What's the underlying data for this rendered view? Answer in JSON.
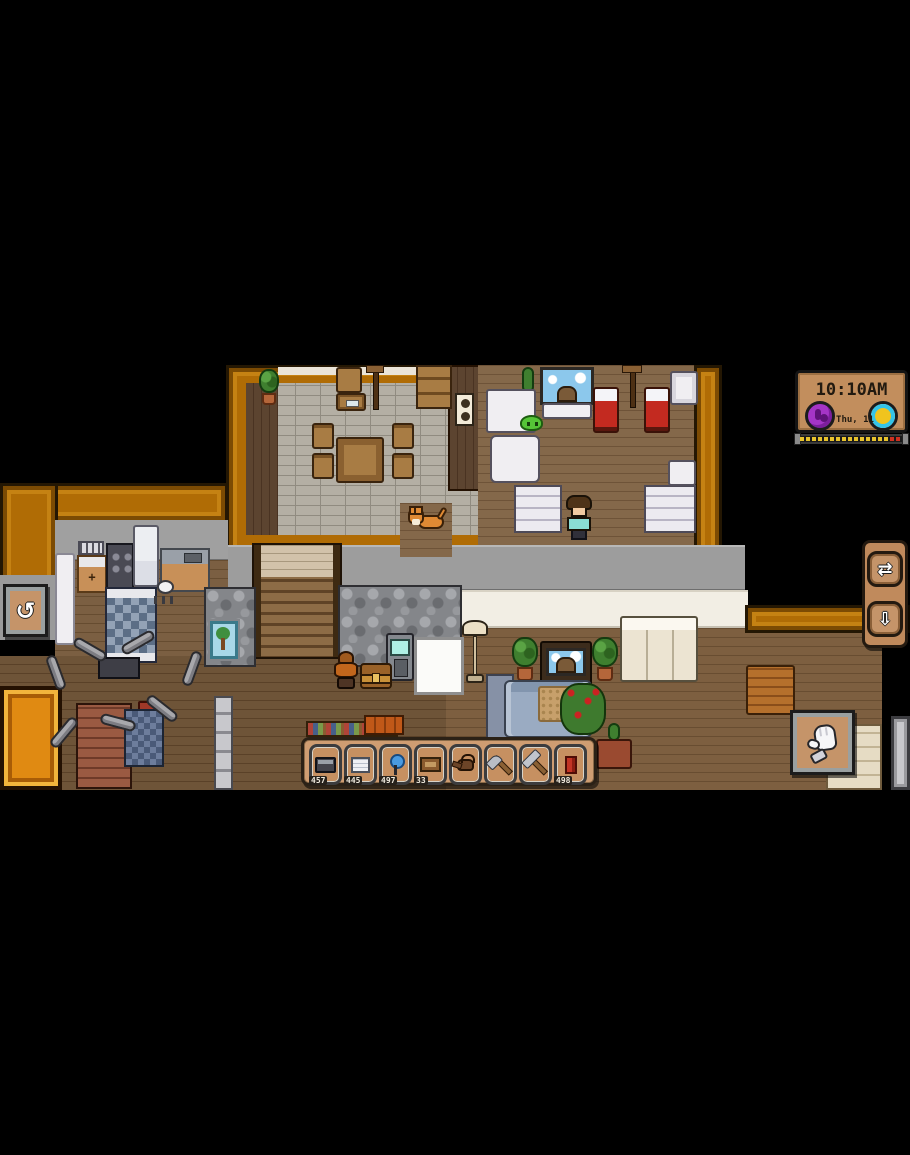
{
  "app": {
    "type": "pixel-life-sim-game",
    "view": "house-interior"
  },
  "clock": {
    "time": "10:10AM",
    "date": "Thu, 11"
  },
  "icons": {
    "rotate": "↺",
    "swap": "⇄",
    "pickup": "⇩"
  },
  "hud": {
    "action_button": {
      "icon": "glove"
    },
    "day_progress_percent": 86
  },
  "hotbar": {
    "slots": [
      {
        "item": "furnace",
        "qty": "457"
      },
      {
        "item": "paper-stack",
        "qty": "445"
      },
      {
        "item": "blue-lamp",
        "qty": "497"
      },
      {
        "item": "crate",
        "qty": "33"
      },
      {
        "item": "watering-can",
        "qty": ""
      },
      {
        "item": "axe",
        "qty": ""
      },
      {
        "item": "hammer",
        "qty": ""
      },
      {
        "item": "red-chair",
        "qty": "498"
      }
    ]
  },
  "colors": {
    "wall_orange": "#b06c05",
    "hud_panel_tan": "#c28e5d",
    "hotbar_tan": "#cf9d72",
    "accent_purple": "#a435c6",
    "accent_cyan": "#35c4e8",
    "accent_yellow": "#f0c41e",
    "bed_red": "#c32a20",
    "day_bar_yellow": "#e8c32c",
    "day_bar_red": "#d03020"
  }
}
